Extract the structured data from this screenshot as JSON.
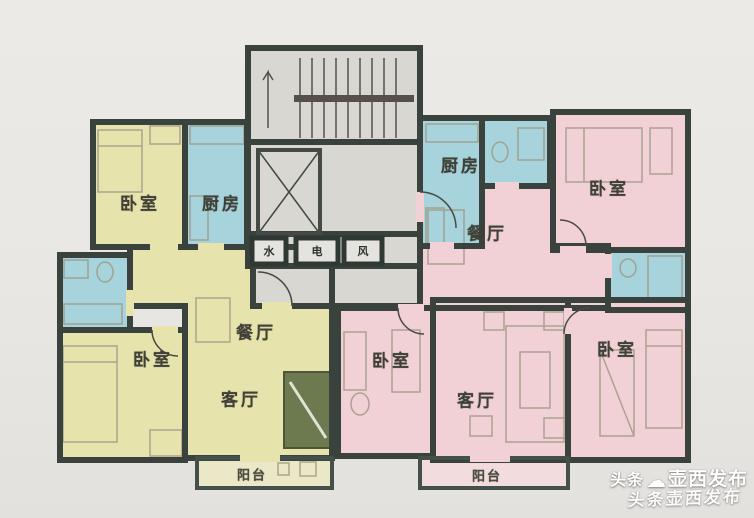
{
  "palette": {
    "background": "#e9e7e3",
    "wall": "#39423d",
    "room_yellow": "#e7e3ad",
    "room_blue": "#a6d3dc",
    "room_pink": "#f1d1d5",
    "core_gray": "#d8d7d1",
    "balcony_yellow": "#eae8c6",
    "balcony_pink": "#f2dcdd",
    "accent_green": "#6d7a50",
    "label_color": "#3f4036"
  },
  "core": {
    "shafts": [
      {
        "label": "水"
      },
      {
        "label": "电"
      },
      {
        "label": "风"
      }
    ]
  },
  "left_unit": {
    "rooms": [
      {
        "id": "left-bedroom-top",
        "label": "卧室"
      },
      {
        "id": "left-kitchen",
        "label": "厨房"
      },
      {
        "id": "left-bedroom-main",
        "label": "卧室"
      },
      {
        "id": "left-dining",
        "label": "餐厅"
      },
      {
        "id": "left-living",
        "label": "客厅"
      },
      {
        "id": "left-balcony",
        "label": "阳台"
      }
    ]
  },
  "right_unit": {
    "rooms": [
      {
        "id": "right-kitchen",
        "label": "厨房"
      },
      {
        "id": "right-dining",
        "label": "餐厅"
      },
      {
        "id": "right-bedroom-top",
        "label": "卧室"
      },
      {
        "id": "right-bedroom-middle",
        "label": "卧室"
      },
      {
        "id": "right-living",
        "label": "客厅"
      },
      {
        "id": "right-bedroom-bottom",
        "label": "卧室"
      },
      {
        "id": "right-balcony",
        "label": "阳台"
      }
    ]
  },
  "watermark": {
    "source": "头条",
    "mascot_icon": "☁",
    "publisher": "壶西发布",
    "ghost_line": "头条壶西发布"
  }
}
